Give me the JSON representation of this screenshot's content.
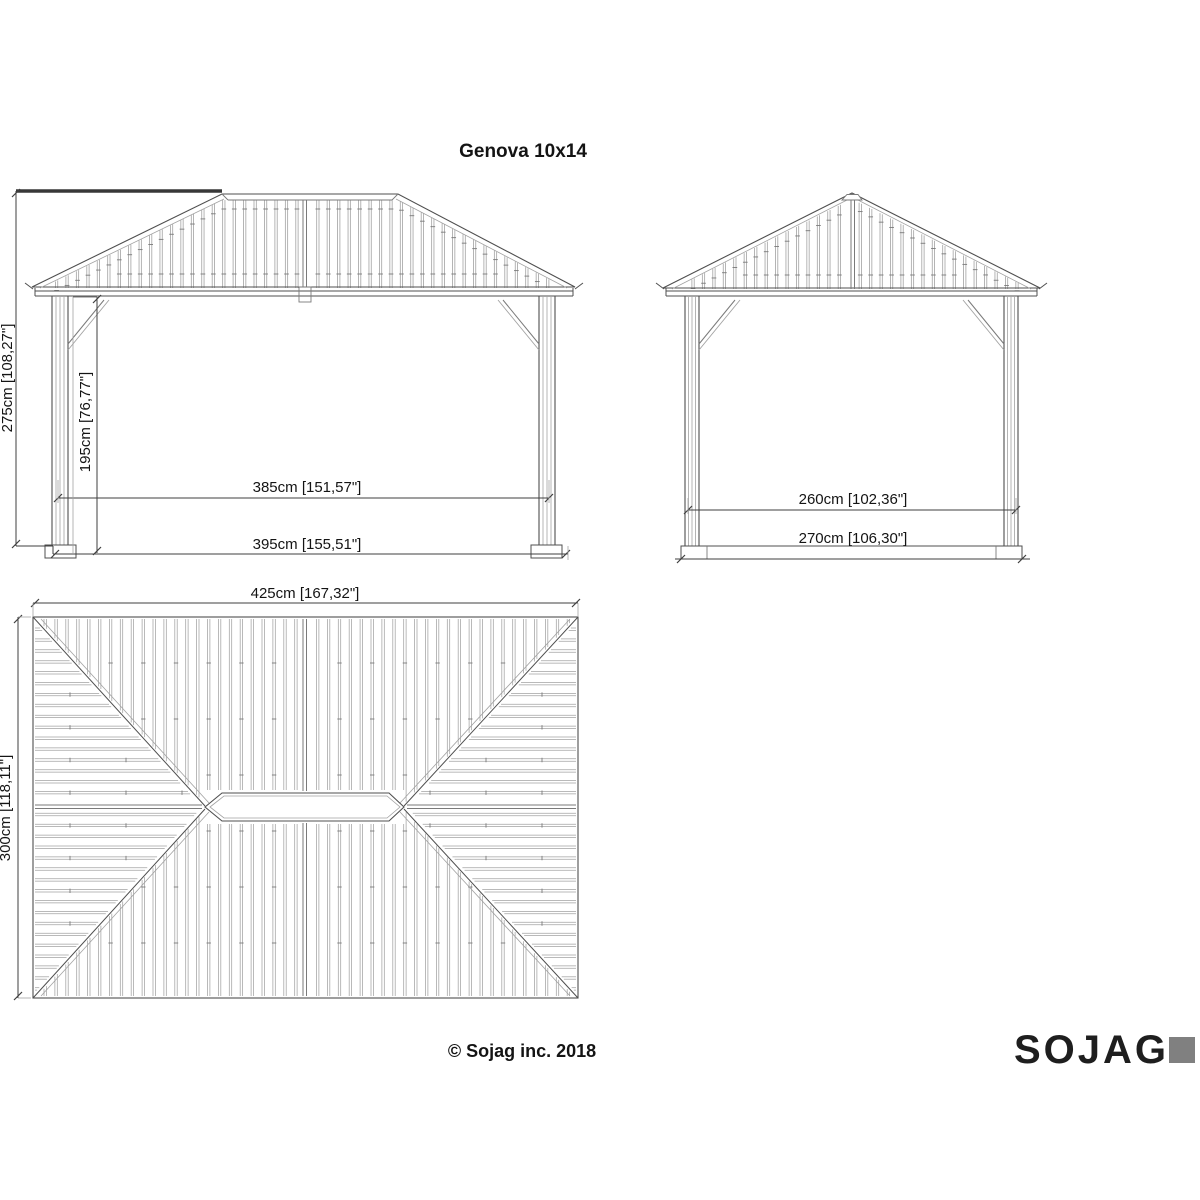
{
  "title": "Genova 10x14",
  "views": {
    "front": {
      "dims": {
        "height_total": "275cm [108,27\"]",
        "height_opening": "195cm [76,77\"]",
        "width_inner": "385cm [151,57\"]",
        "width_outer": "395cm [155,51\"]"
      }
    },
    "side": {
      "dims": {
        "depth_inner": "260cm [102,36\"]",
        "depth_outer": "270cm [106,30\"]"
      }
    },
    "plan": {
      "dims": {
        "roof_width": "425cm [167,32\"]",
        "roof_depth": "300cm [118,11\"]"
      }
    }
  },
  "footer": {
    "copyright": "© Sojag inc. 2018",
    "brand": "SOJAG"
  },
  "colors": {
    "background": "#ffffff",
    "line": "#4f4f4f",
    "line_mid": "#7a7a7a",
    "line_light": "#a2a2a2",
    "dim": "#3f3f3f",
    "thick": "#383838",
    "text": "#141414",
    "brand_dark": "#1e1e1e",
    "brand_gray": "#808080"
  }
}
